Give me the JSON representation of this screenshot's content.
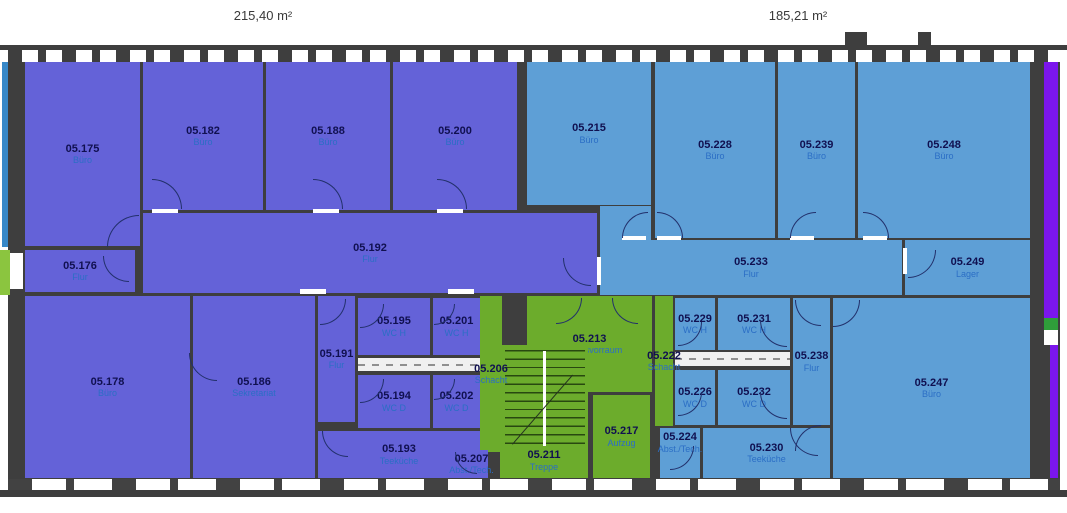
{
  "areas": {
    "left": "215,40 m²",
    "right": "185,21 m²"
  },
  "colors": {
    "unit_left_fill": "#6462d8",
    "unit_right_fill": "#5e9fd6",
    "core_fill": "#6cac2c",
    "wall": "#3e3e3e",
    "room_number_text": "#101050",
    "room_type_text": "#2b6ec5",
    "adjacent_violet": "#7b16ec",
    "adjacent_green": "#2f9e3a",
    "adjacent_teal": "#3788c8",
    "adjacent_lime": "#8bc53f"
  },
  "rooms": [
    {
      "number": "05.175",
      "type": "Büro"
    },
    {
      "number": "05.182",
      "type": "Büro"
    },
    {
      "number": "05.188",
      "type": "Büro"
    },
    {
      "number": "05.200",
      "type": "Büro"
    },
    {
      "number": "05.176",
      "type": "Flur"
    },
    {
      "number": "05.192",
      "type": "Flur"
    },
    {
      "number": "05.178",
      "type": "Büro"
    },
    {
      "number": "05.186",
      "type": "Sekretariat"
    },
    {
      "number": "05.191",
      "type": "Flur"
    },
    {
      "number": "05.195",
      "type": "WC H"
    },
    {
      "number": "05.201",
      "type": "WC H"
    },
    {
      "number": "05.194",
      "type": "WC D"
    },
    {
      "number": "05.202",
      "type": "WC D"
    },
    {
      "number": "05.206",
      "type": "Schacht"
    },
    {
      "number": "05.193",
      "type": "Teeküche"
    },
    {
      "number": "05.207",
      "type": "Abst./Tech."
    },
    {
      "number": "05.213",
      "type": "Aufzugsvorraum"
    },
    {
      "number": "05.211",
      "type": "Treppe"
    },
    {
      "number": "05.217",
      "type": "Aufzug"
    },
    {
      "number": "05.222",
      "type": "Schacht"
    },
    {
      "number": "05.215",
      "type": "Büro"
    },
    {
      "number": "05.228",
      "type": "Büro"
    },
    {
      "number": "05.239",
      "type": "Büro"
    },
    {
      "number": "05.248",
      "type": "Büro"
    },
    {
      "number": "05.233",
      "type": "Flur"
    },
    {
      "number": "05.249",
      "type": "Lager"
    },
    {
      "number": "05.229",
      "type": "WC H"
    },
    {
      "number": "05.231",
      "type": "WC H"
    },
    {
      "number": "05.226",
      "type": "WC D"
    },
    {
      "number": "05.232",
      "type": "WC D"
    },
    {
      "number": "05.238",
      "type": "Flur"
    },
    {
      "number": "05.224",
      "type": "Abst./Tech."
    },
    {
      "number": "05.230",
      "type": "Teeküche"
    },
    {
      "number": "05.247",
      "type": "Büro"
    }
  ]
}
